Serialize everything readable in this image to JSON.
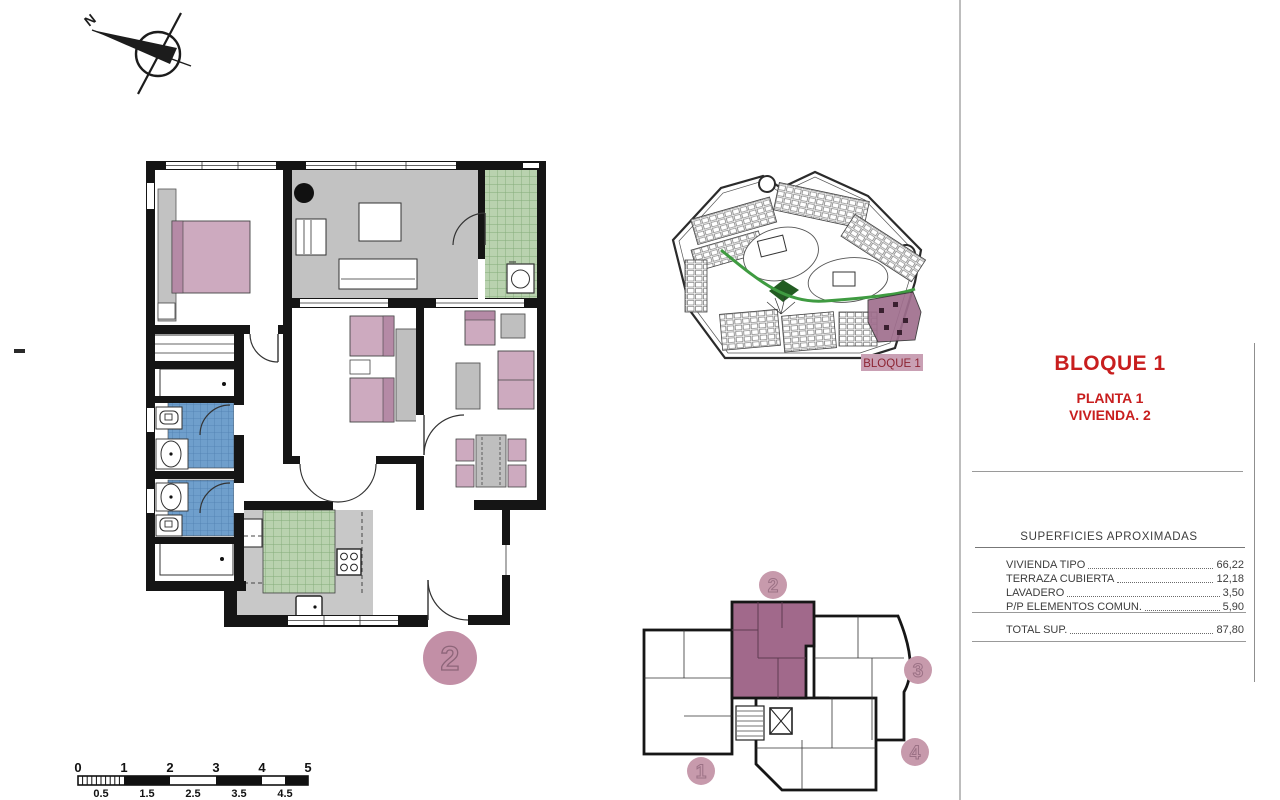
{
  "compass": {
    "label": "N"
  },
  "title_block": {
    "block": "BLOQUE 1",
    "floor": "PLANTA 1",
    "unit": "VIVIENDA. 2",
    "accent_color": "#c81e1e"
  },
  "site_plan": {
    "block_label": "BLOQUE 1",
    "highlight_color": "#a06f8e",
    "label_bg": "#c9a0b4",
    "green_path_color": "#3f9b41"
  },
  "areas_table": {
    "header": "SUPERFICIES APROXIMADAS",
    "rows": [
      {
        "label": "VIVIENDA TIPO",
        "value": "66,22"
      },
      {
        "label": "TERRAZA CUBIERTA",
        "value": "12,18"
      },
      {
        "label": "LAVADERO",
        "value": "3,50"
      },
      {
        "label": "P/P ELEMENTOS COMUN.",
        "value": "5,90"
      }
    ],
    "total": {
      "label": "TOTAL SUP.",
      "value": "87,80"
    }
  },
  "floor_plan": {
    "unit_marker": "2",
    "marker_color": "#c28fa6",
    "wall_color": "#151515",
    "terrace_color": "#c2c2c2",
    "tile_green": "#b9d2af",
    "tile_blue": "#6f9fcc",
    "furniture_pink": "#cdaabf"
  },
  "key_plan": {
    "unit_labels": [
      "1",
      "2",
      "3",
      "4"
    ],
    "highlighted_unit": "2",
    "highlight_fill": "#a1698b",
    "marker_fill": "#c79aac"
  },
  "scale_bar": {
    "major_labels": [
      "0",
      "1",
      "2",
      "3",
      "4",
      "5"
    ],
    "minor_labels": [
      "0.5",
      "1.5",
      "2.5",
      "3.5",
      "4.5"
    ]
  }
}
